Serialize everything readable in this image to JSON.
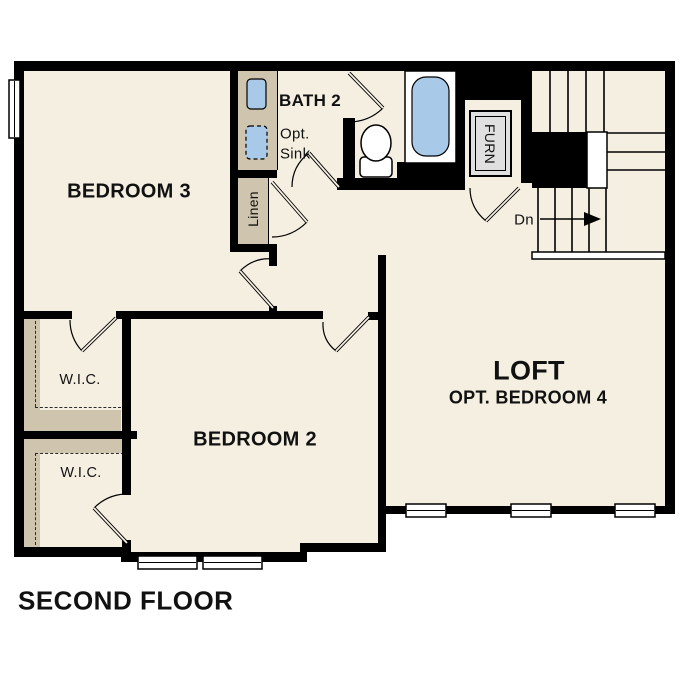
{
  "title": "SECOND FLOOR",
  "rooms": {
    "bedroom3": "BEDROOM 3",
    "bath2": "BATH 2",
    "bedroom2": "BEDROOM 2",
    "loft": "LOFT",
    "loft_sub": "OPT. BEDROOM 4",
    "wic1": "W.I.C.",
    "wic2": "W.I.C."
  },
  "annotations": {
    "opt_sink_line1": "Opt.",
    "opt_sink_line2": "Sink",
    "linen": "Linen",
    "furnace": "FURN",
    "stairs_down": "Dn"
  },
  "colors": {
    "floor": "#f5efe2",
    "wall": "#000000",
    "casework": "#cfc4ad",
    "fixture_blue": "#a9c9e8",
    "furnace_fill": "#e0e0e0"
  }
}
